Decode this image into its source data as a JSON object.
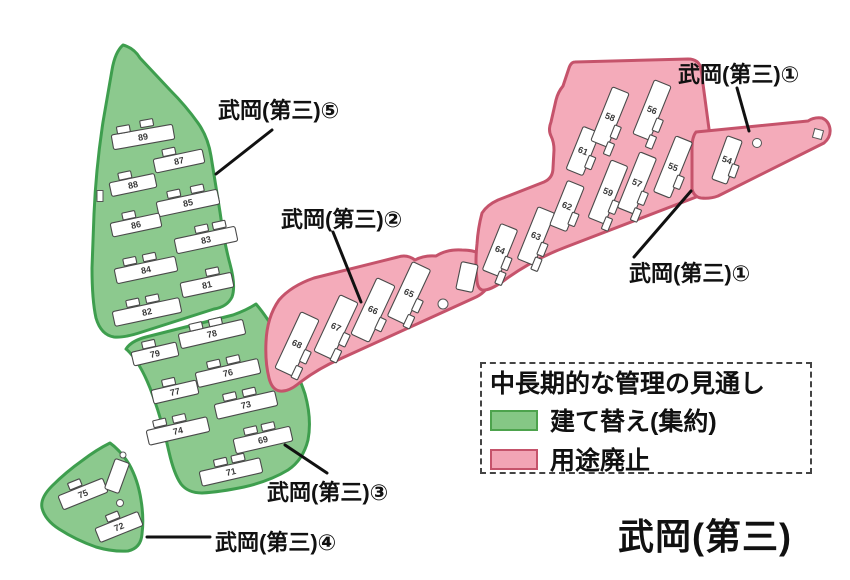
{
  "title": "武岡(第三)",
  "legend": {
    "title": "中長期的な管理の見通し",
    "items": [
      {
        "label": "建て替え(集約)",
        "color": "#85C785",
        "border": "#4DA34D"
      },
      {
        "label": "用途廃止",
        "color": "#F2A4B5",
        "border": "#C5536B"
      }
    ]
  },
  "colors": {
    "green_fill": "#8CC98E",
    "green_stroke": "#3E9E4E",
    "pink_fill": "#F4ABBA",
    "pink_stroke": "#C5536B",
    "building_fill": "#FFFFFF",
    "label_color": "#111111"
  },
  "map_labels": [
    {
      "name": "label-daisan-1-upper",
      "text": "武岡(第三)①",
      "x": 678,
      "y": 82,
      "line": [
        737,
        88,
        749,
        131
      ]
    },
    {
      "name": "label-daisan-1-lower",
      "text": "武岡(第三)①",
      "x": 629,
      "y": 281,
      "line": [
        691,
        191,
        634,
        257
      ]
    },
    {
      "name": "label-daisan-2",
      "text": "武岡(第三)②",
      "x": 281,
      "y": 227,
      "line": [
        333,
        232,
        361,
        302
      ]
    },
    {
      "name": "label-daisan-3",
      "text": "武岡(第三)③",
      "x": 267,
      "y": 500,
      "line": [
        285,
        445,
        327,
        473
      ]
    },
    {
      "name": "label-daisan-4",
      "text": "武岡(第三)④",
      "x": 215,
      "y": 550,
      "line": [
        147,
        537,
        210,
        537
      ]
    },
    {
      "name": "label-daisan-5",
      "text": "武岡(第三)⑤",
      "x": 218,
      "y": 118,
      "line": [
        272,
        130,
        216,
        174
      ]
    }
  ],
  "buildings": {
    "green": [
      {
        "n": "89",
        "x": 143,
        "y": 137,
        "w": 62,
        "h": 15,
        "r": -10,
        "a": [
          [
            -18,
            -11
          ],
          [
            6,
            -13
          ]
        ]
      },
      {
        "n": "87",
        "x": 179,
        "y": 161,
        "w": 50,
        "h": 14,
        "r": -12,
        "a": [
          [
            -8,
            -11
          ]
        ]
      },
      {
        "n": "88",
        "x": 133,
        "y": 185,
        "w": 46,
        "h": 14,
        "r": -12,
        "a": [
          [
            -6,
            -11
          ]
        ]
      },
      {
        "n": "85",
        "x": 188,
        "y": 203,
        "w": 62,
        "h": 15,
        "r": -12,
        "a": [
          [
            -12,
            -12
          ],
          [
            12,
            -12
          ]
        ]
      },
      {
        "n": "86",
        "x": 136,
        "y": 225,
        "w": 50,
        "h": 14,
        "r": -12,
        "a": [
          [
            -5,
            -11
          ]
        ]
      },
      {
        "n": "83",
        "x": 206,
        "y": 240,
        "w": 62,
        "h": 15,
        "r": -12,
        "a": [
          [
            -2,
            -12
          ],
          [
            16,
            -12
          ]
        ]
      },
      {
        "n": "84",
        "x": 146,
        "y": 270,
        "w": 62,
        "h": 15,
        "r": -12,
        "a": [
          [
            -14,
            -12
          ],
          [
            6,
            -12
          ]
        ]
      },
      {
        "n": "81",
        "x": 207,
        "y": 285,
        "w": 52,
        "h": 15,
        "r": -12,
        "a": [
          [
            8,
            -12
          ]
        ]
      },
      {
        "n": "82",
        "x": 147,
        "y": 312,
        "w": 68,
        "h": 15,
        "r": -12,
        "a": [
          [
            -12,
            -12
          ],
          [
            8,
            -12
          ]
        ]
      },
      {
        "n": "78",
        "x": 212,
        "y": 334,
        "w": 66,
        "h": 15,
        "r": -13,
        "a": [
          [
            -14,
            -11
          ],
          [
            6,
            -11
          ]
        ]
      },
      {
        "n": "79",
        "x": 155,
        "y": 354,
        "w": 46,
        "h": 14,
        "r": -13,
        "a": [
          [
            -4,
            -11
          ]
        ]
      },
      {
        "n": "76",
        "x": 228,
        "y": 373,
        "w": 64,
        "h": 15,
        "r": -13,
        "a": [
          [
            -12,
            -12
          ],
          [
            8,
            -12
          ]
        ]
      },
      {
        "n": "77",
        "x": 175,
        "y": 392,
        "w": 46,
        "h": 14,
        "r": -13,
        "a": [
          [
            -4,
            -11
          ]
        ]
      },
      {
        "n": "73",
        "x": 246,
        "y": 405,
        "w": 62,
        "h": 15,
        "r": -13,
        "a": [
          [
            -14,
            -12
          ],
          [
            6,
            -12
          ]
        ]
      },
      {
        "n": "74",
        "x": 178,
        "y": 431,
        "w": 62,
        "h": 15,
        "r": -13,
        "a": [
          [
            -16,
            -12
          ],
          [
            4,
            -12
          ]
        ]
      },
      {
        "n": "69",
        "x": 263,
        "y": 440,
        "w": 58,
        "h": 15,
        "r": -13,
        "a": [
          [
            -10,
            -12
          ],
          [
            8,
            -12
          ]
        ]
      },
      {
        "n": "71",
        "x": 231,
        "y": 472,
        "w": 62,
        "h": 15,
        "r": -13,
        "a": [
          [
            -8,
            -12
          ],
          [
            10,
            -12
          ]
        ]
      },
      {
        "n": "75",
        "x": 83,
        "y": 494,
        "w": 48,
        "h": 15,
        "r": -22,
        "a": [
          [
            -4,
            -12
          ]
        ]
      },
      {
        "n": "72",
        "x": 119,
        "y": 527,
        "w": 46,
        "h": 15,
        "r": -22,
        "a": [
          [
            -2,
            -12
          ]
        ]
      },
      {
        "n": "",
        "x": 117,
        "y": 476,
        "w": 15,
        "h": 32,
        "r": 20,
        "a": []
      }
    ],
    "pink": [
      {
        "n": "68",
        "x": 297,
        "y": 344,
        "w": 20,
        "h": 62,
        "r": 25,
        "a": [
          [
            13,
            8
          ],
          [
            12,
            26
          ]
        ]
      },
      {
        "n": "67",
        "x": 336,
        "y": 327,
        "w": 20,
        "h": 62,
        "r": 25,
        "a": [
          [
            13,
            8
          ],
          [
            12,
            26
          ]
        ]
      },
      {
        "n": "66",
        "x": 373,
        "y": 310,
        "w": 20,
        "h": 62,
        "r": 25,
        "a": [
          [
            13,
            10
          ]
        ]
      },
      {
        "n": "65",
        "x": 409,
        "y": 293,
        "w": 20,
        "h": 60,
        "r": 25,
        "a": [
          [
            13,
            8
          ],
          [
            12,
            26
          ]
        ]
      },
      {
        "n": "",
        "x": 467,
        "y": 277,
        "w": 17,
        "h": 28,
        "r": 12,
        "a": []
      },
      {
        "n": "64",
        "x": 500,
        "y": 250,
        "w": 18,
        "h": 50,
        "r": 22,
        "a": [
          [
            11,
            10
          ],
          [
            11,
            26
          ]
        ]
      },
      {
        "n": "63",
        "x": 536,
        "y": 236,
        "w": 18,
        "h": 56,
        "r": 22,
        "a": [
          [
            11,
            10
          ],
          [
            11,
            26
          ]
        ]
      },
      {
        "n": "62",
        "x": 567,
        "y": 206,
        "w": 18,
        "h": 48,
        "r": 22,
        "a": [
          [
            11,
            10
          ]
        ]
      },
      {
        "n": "59",
        "x": 608,
        "y": 192,
        "w": 18,
        "h": 62,
        "r": 22,
        "a": [
          [
            11,
            12
          ],
          [
            11,
            30
          ]
        ]
      },
      {
        "n": "61",
        "x": 583,
        "y": 151,
        "w": 18,
        "h": 46,
        "r": 22,
        "a": [
          [
            11,
            8
          ]
        ]
      },
      {
        "n": "58",
        "x": 610,
        "y": 117,
        "w": 18,
        "h": 58,
        "r": 22,
        "a": [
          [
            11,
            12
          ],
          [
            11,
            30
          ]
        ]
      },
      {
        "n": "56",
        "x": 652,
        "y": 110,
        "w": 18,
        "h": 58,
        "r": 22,
        "a": [
          [
            11,
            12
          ],
          [
            11,
            30
          ]
        ]
      },
      {
        "n": "57",
        "x": 637,
        "y": 183,
        "w": 18,
        "h": 60,
        "r": 22,
        "a": [
          [
            11,
            12
          ],
          [
            11,
            30
          ]
        ]
      },
      {
        "n": "55",
        "x": 673,
        "y": 167,
        "w": 18,
        "h": 60,
        "r": 22,
        "a": [
          [
            11,
            12
          ]
        ]
      },
      {
        "n": "54",
        "x": 727,
        "y": 160,
        "w": 16,
        "h": 46,
        "r": 20,
        "a": [
          [
            10,
            8
          ]
        ]
      }
    ]
  },
  "holes": [
    {
      "s": "c",
      "x": 443,
      "y": 304,
      "r": 5
    },
    {
      "s": "c",
      "x": 757,
      "y": 143,
      "r": 4.5
    },
    {
      "s": "r",
      "x": 818,
      "y": 134,
      "w": 9,
      "h": 9,
      "rot": 15
    },
    {
      "s": "c",
      "x": 123,
      "y": 455,
      "r": 3
    },
    {
      "s": "c",
      "x": 120,
      "y": 503,
      "r": 3.5
    },
    {
      "s": "r",
      "x": 100,
      "y": 196,
      "w": 6,
      "h": 11,
      "rot": 0
    }
  ]
}
